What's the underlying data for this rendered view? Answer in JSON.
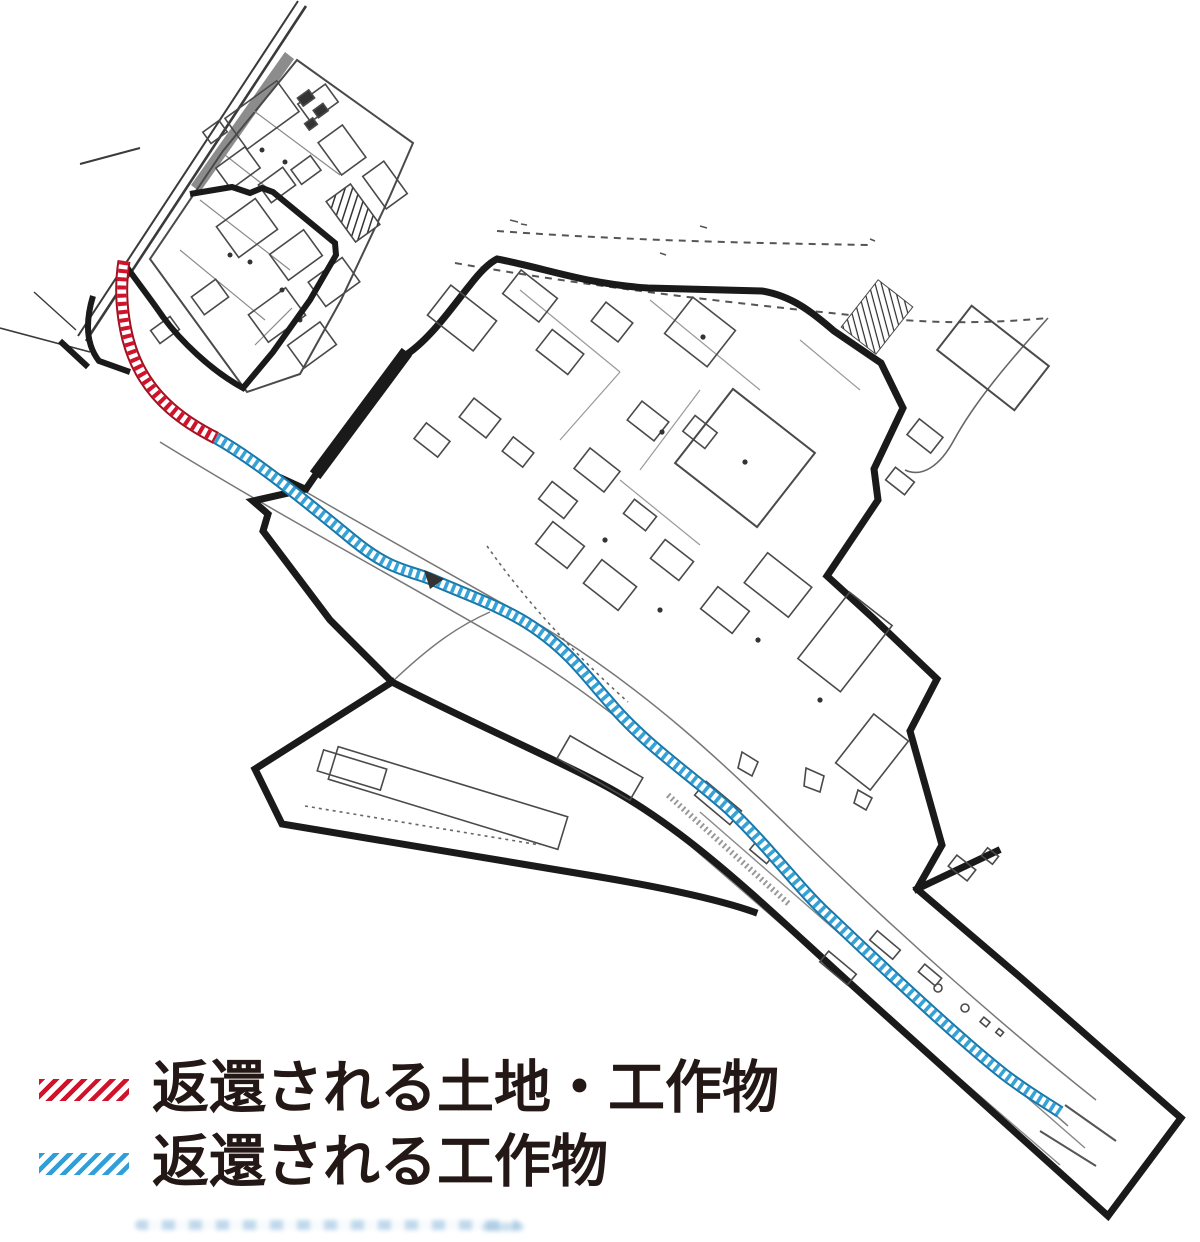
{
  "legend": {
    "items": [
      {
        "id": "returned-land-and-structures",
        "label": "返還される土地・工作物",
        "swatch_color": "#d0122b"
      },
      {
        "id": "returned-structures",
        "label": "返還される工作物",
        "swatch_color": "#2f9fd8"
      }
    ]
  },
  "map": {
    "colors": {
      "returned_land_hatch": "#d0122b",
      "returned_land_edge": "#a50f20",
      "returned_structures_hatch": "#35a3d8",
      "returned_structures_edge": "#1878aa",
      "boundary_line": "#1a1a1a",
      "thin_line": "#4a4a4a"
    }
  }
}
